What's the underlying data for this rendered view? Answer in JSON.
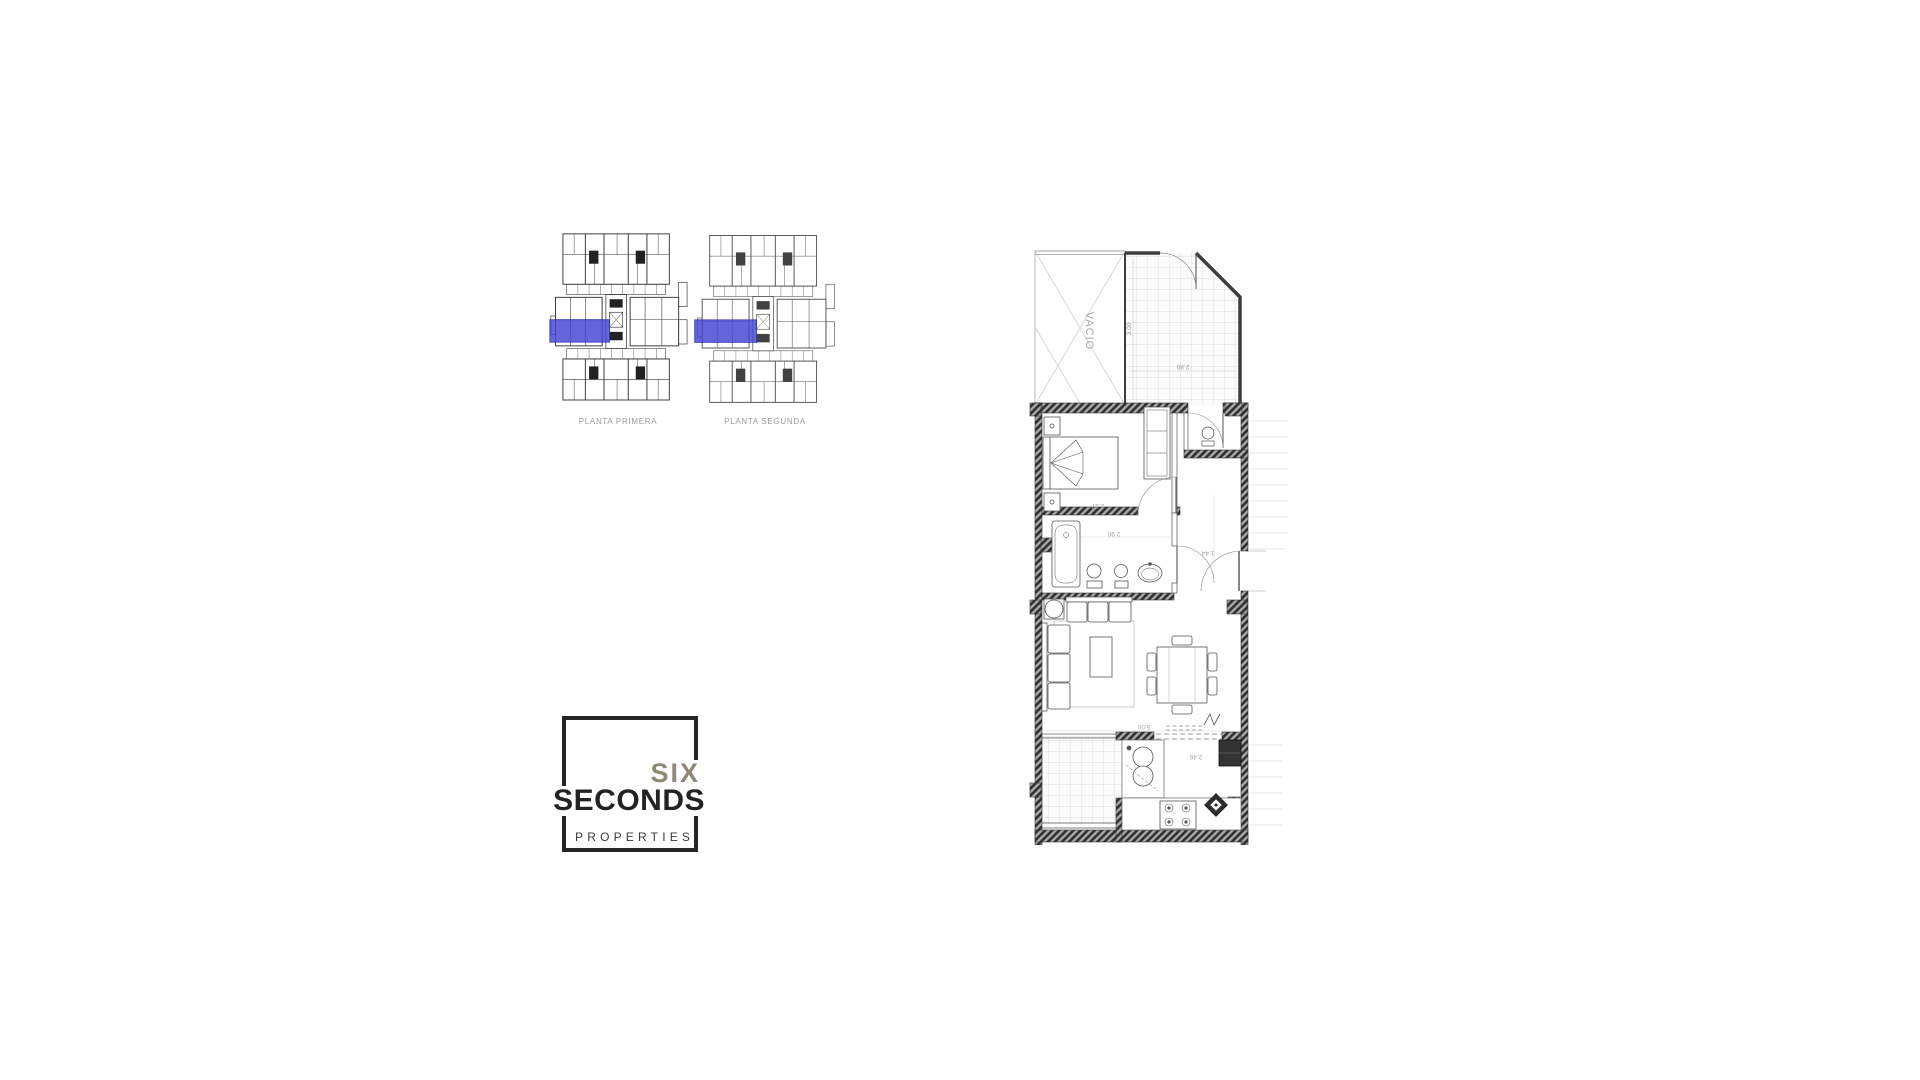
{
  "overview": {
    "floors": [
      {
        "label": "PLANTA PRIMERA"
      },
      {
        "label": "PLANTA SEGUNDA"
      }
    ],
    "highlight_color": "#4444d4"
  },
  "logo": {
    "word1": "SIX",
    "word2": "SECONDS",
    "word3": "PROPERTIES"
  },
  "plan": {
    "room_label": "VACIO",
    "dims": {
      "terrace_depth": "3.00",
      "terrace_width": "2.80",
      "bedroom_width": "2.17",
      "bathroom_width": "2.90",
      "hall_width": "1.44",
      "living_width": "5.00",
      "kitchen_width": "2.46"
    }
  }
}
